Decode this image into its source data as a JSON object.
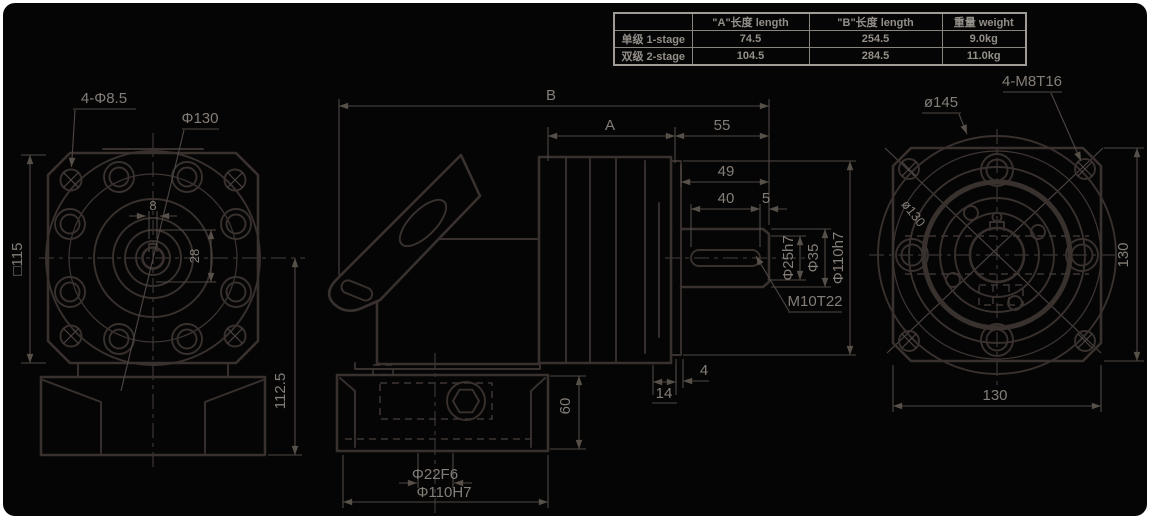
{
  "table": {
    "col_headers": [
      "",
      "\"A\"长度 length",
      "\"B\"长度  length",
      "重量 weight"
    ],
    "rows": [
      {
        "label": "单级 1-stage",
        "a": "74.5",
        "b": "254.5",
        "weight": "9.0kg"
      },
      {
        "label": "双级 2-stage",
        "a": "104.5",
        "b": "284.5",
        "weight": "11.0kg"
      }
    ]
  },
  "front_view": {
    "corner_holes": "4-Φ8.5",
    "bolt_circle_dia": "Φ130",
    "key_width": "8",
    "key_height": "28",
    "flange_square": "□115",
    "center_to_base": "112.5"
  },
  "side_view": {
    "overall_length_label": "B",
    "stage_length_label": "A",
    "output_section_length": "55",
    "shaft_length": "49",
    "key_length": "40",
    "key_end_gap": "5",
    "shaft_dia": "Φ25h7",
    "collar_dia": "Φ35",
    "pilot_dia": "Φ110h7",
    "shaft_tap": "M10T22",
    "flange_gap": "4",
    "flange_thickness": "14",
    "base_height": "60",
    "input_bore": "Φ22F6",
    "input_pilot": "Φ110H7"
  },
  "back_view": {
    "outer_dia": "ø145",
    "corner_taps": "4-M8T16",
    "bolt_circle_dia": "ø130",
    "flange_height": "130",
    "flange_width": "130"
  }
}
